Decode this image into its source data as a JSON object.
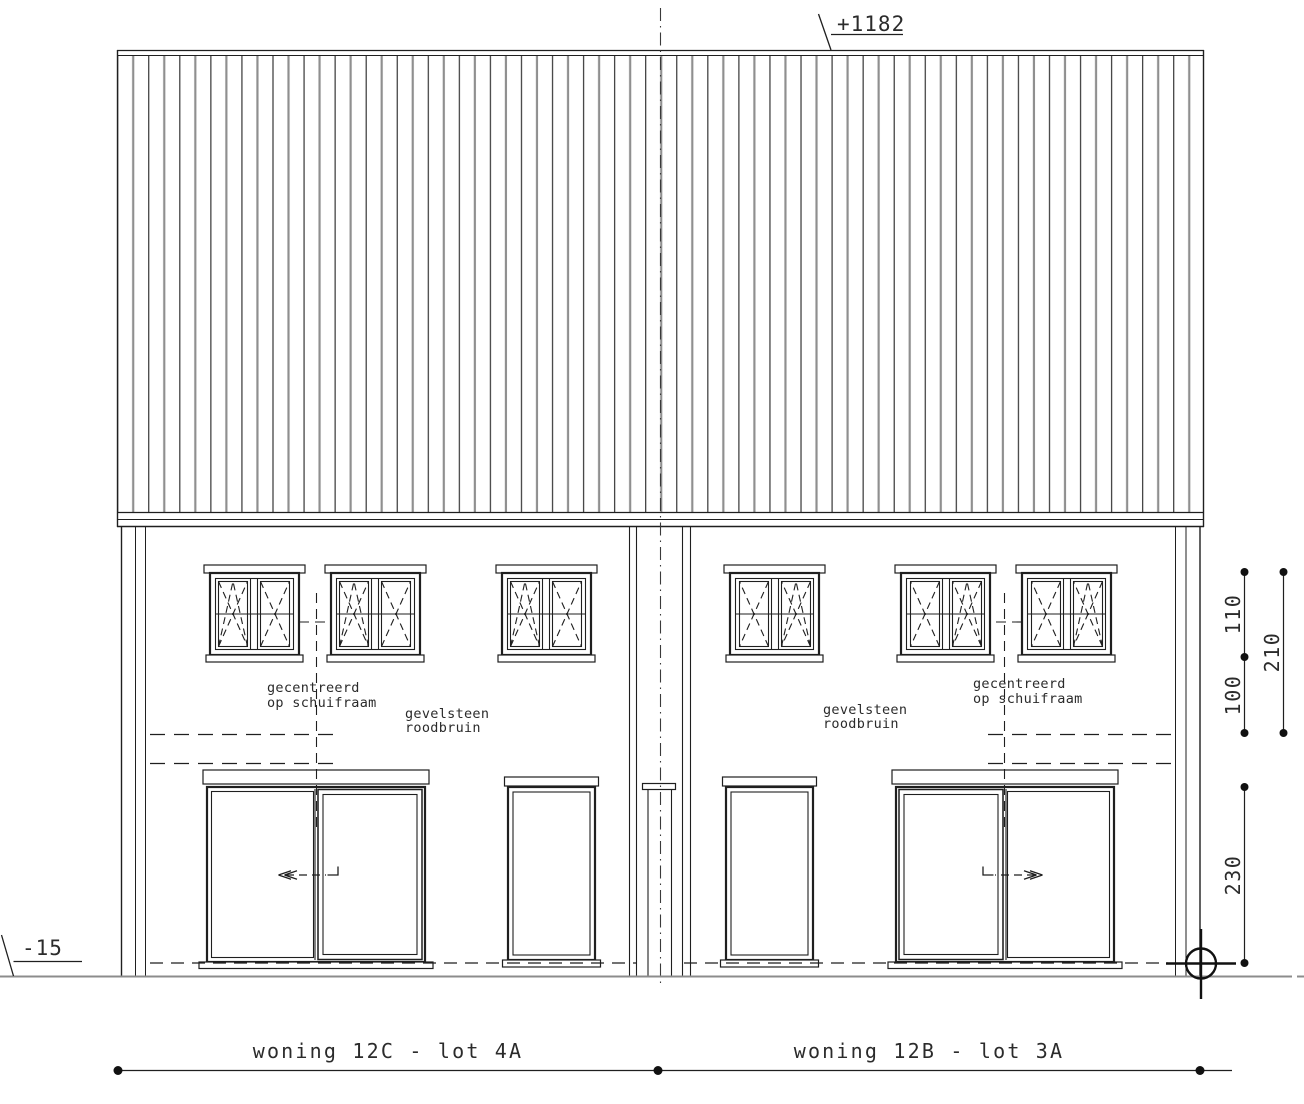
{
  "annotations": {
    "peak_level": "+1182",
    "ground_level": "-15"
  },
  "dimensions": {
    "dim_110": "110",
    "dim_210": "210",
    "dim_100": "100",
    "dim_230": "230"
  },
  "left_house": {
    "lot_label": "woning 12C - lot 4A",
    "centered_note": [
      "gecentreerd",
      "op schuifraam"
    ],
    "material_note": [
      "gevelsteen",
      "roodbruin"
    ]
  },
  "right_house": {
    "lot_label": "woning 12B - lot 3A",
    "centered_note": [
      "gecentreerd",
      "op schuifraam"
    ],
    "material_note": [
      "gevelsteen",
      "roodbruin"
    ]
  },
  "colors": {
    "line": "#1f1f1f",
    "roof_gray": "#8f8f8f",
    "ground_gray": "#8c8c8c",
    "text": "#2b2b2b"
  }
}
